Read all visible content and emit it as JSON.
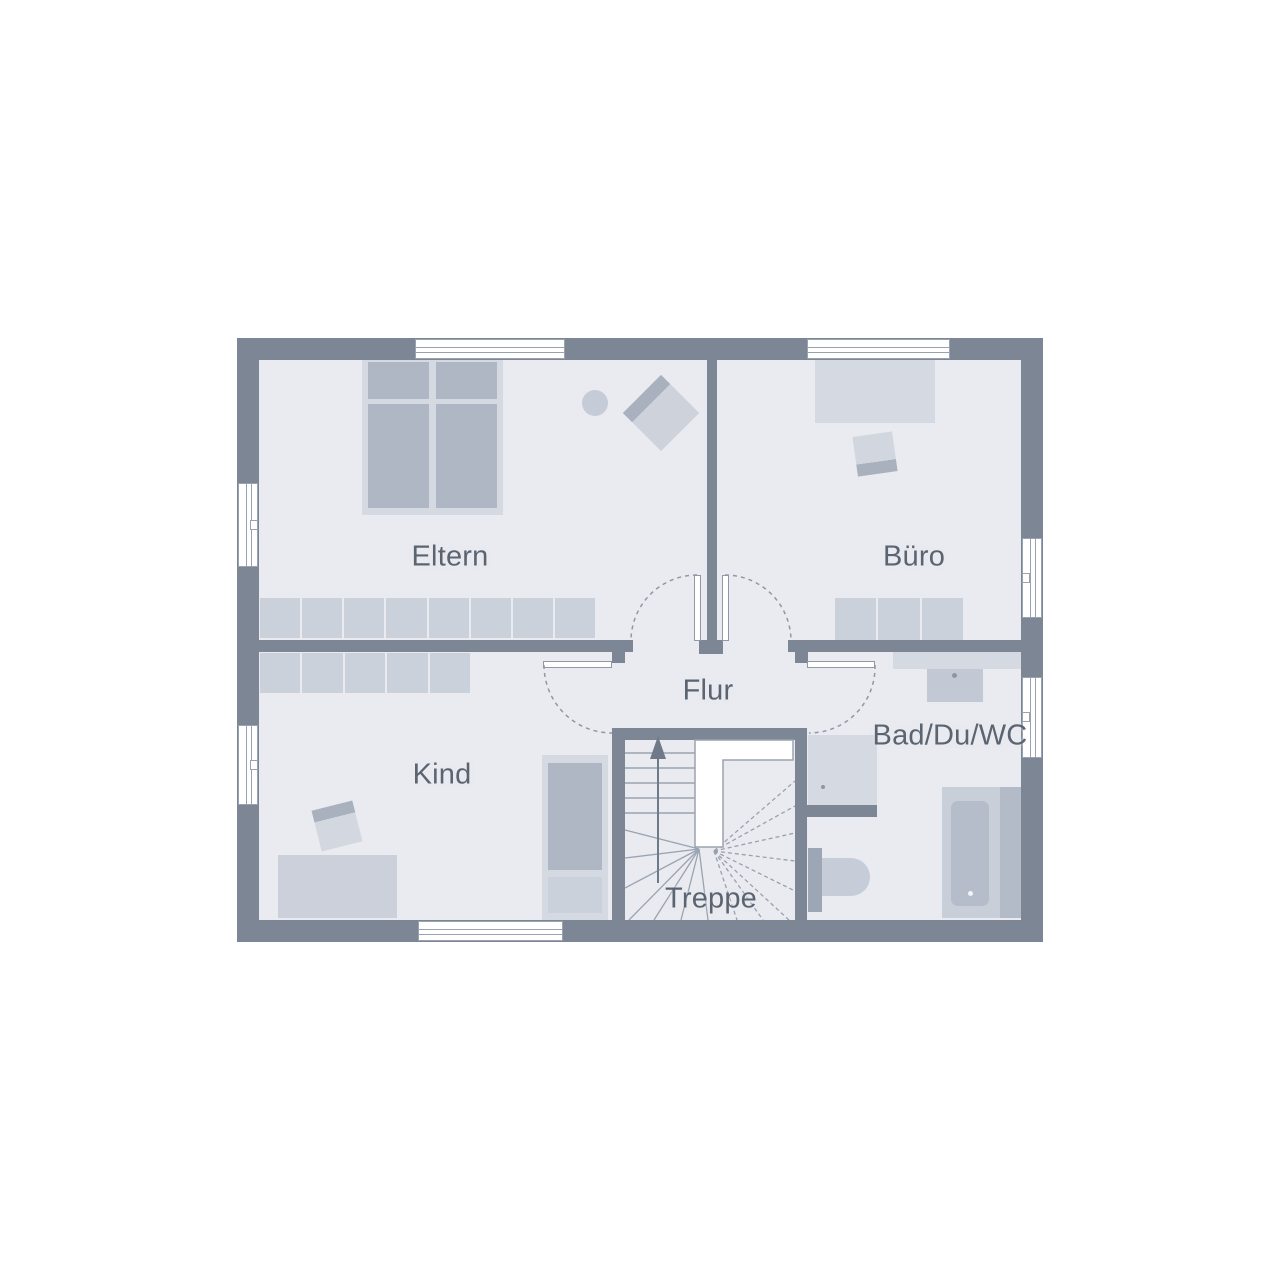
{
  "floorplan": {
    "type": "residential-floor-plan",
    "rooms": [
      {
        "id": "eltern",
        "label": "Eltern"
      },
      {
        "id": "buero",
        "label": "Büro"
      },
      {
        "id": "flur",
        "label": "Flur"
      },
      {
        "id": "kind",
        "label": "Kind"
      },
      {
        "id": "bad",
        "label": "Bad/Du/WC"
      },
      {
        "id": "treppe",
        "label": "Treppe"
      }
    ],
    "palette": {
      "background": "#FFFFFF",
      "wall": "#7C8695",
      "floor": "#E9EBF0",
      "furniture_light": "#D4D9E2",
      "furniture_mid": "#CBD1DB",
      "furniture_dark": "#AFB7C4",
      "line": "#9AA3B0",
      "dashed_line": "#8F98A6",
      "text": "#5B6470"
    },
    "icons": [
      {
        "id": "up-arrow-icon",
        "meaning": "stair direction up"
      }
    ],
    "features": {
      "doors": [
        "Eltern",
        "Büro",
        "Kind",
        "Bad/Du/WC"
      ],
      "windows_count": 7,
      "stair_type": "U-shaped winder stair"
    }
  }
}
